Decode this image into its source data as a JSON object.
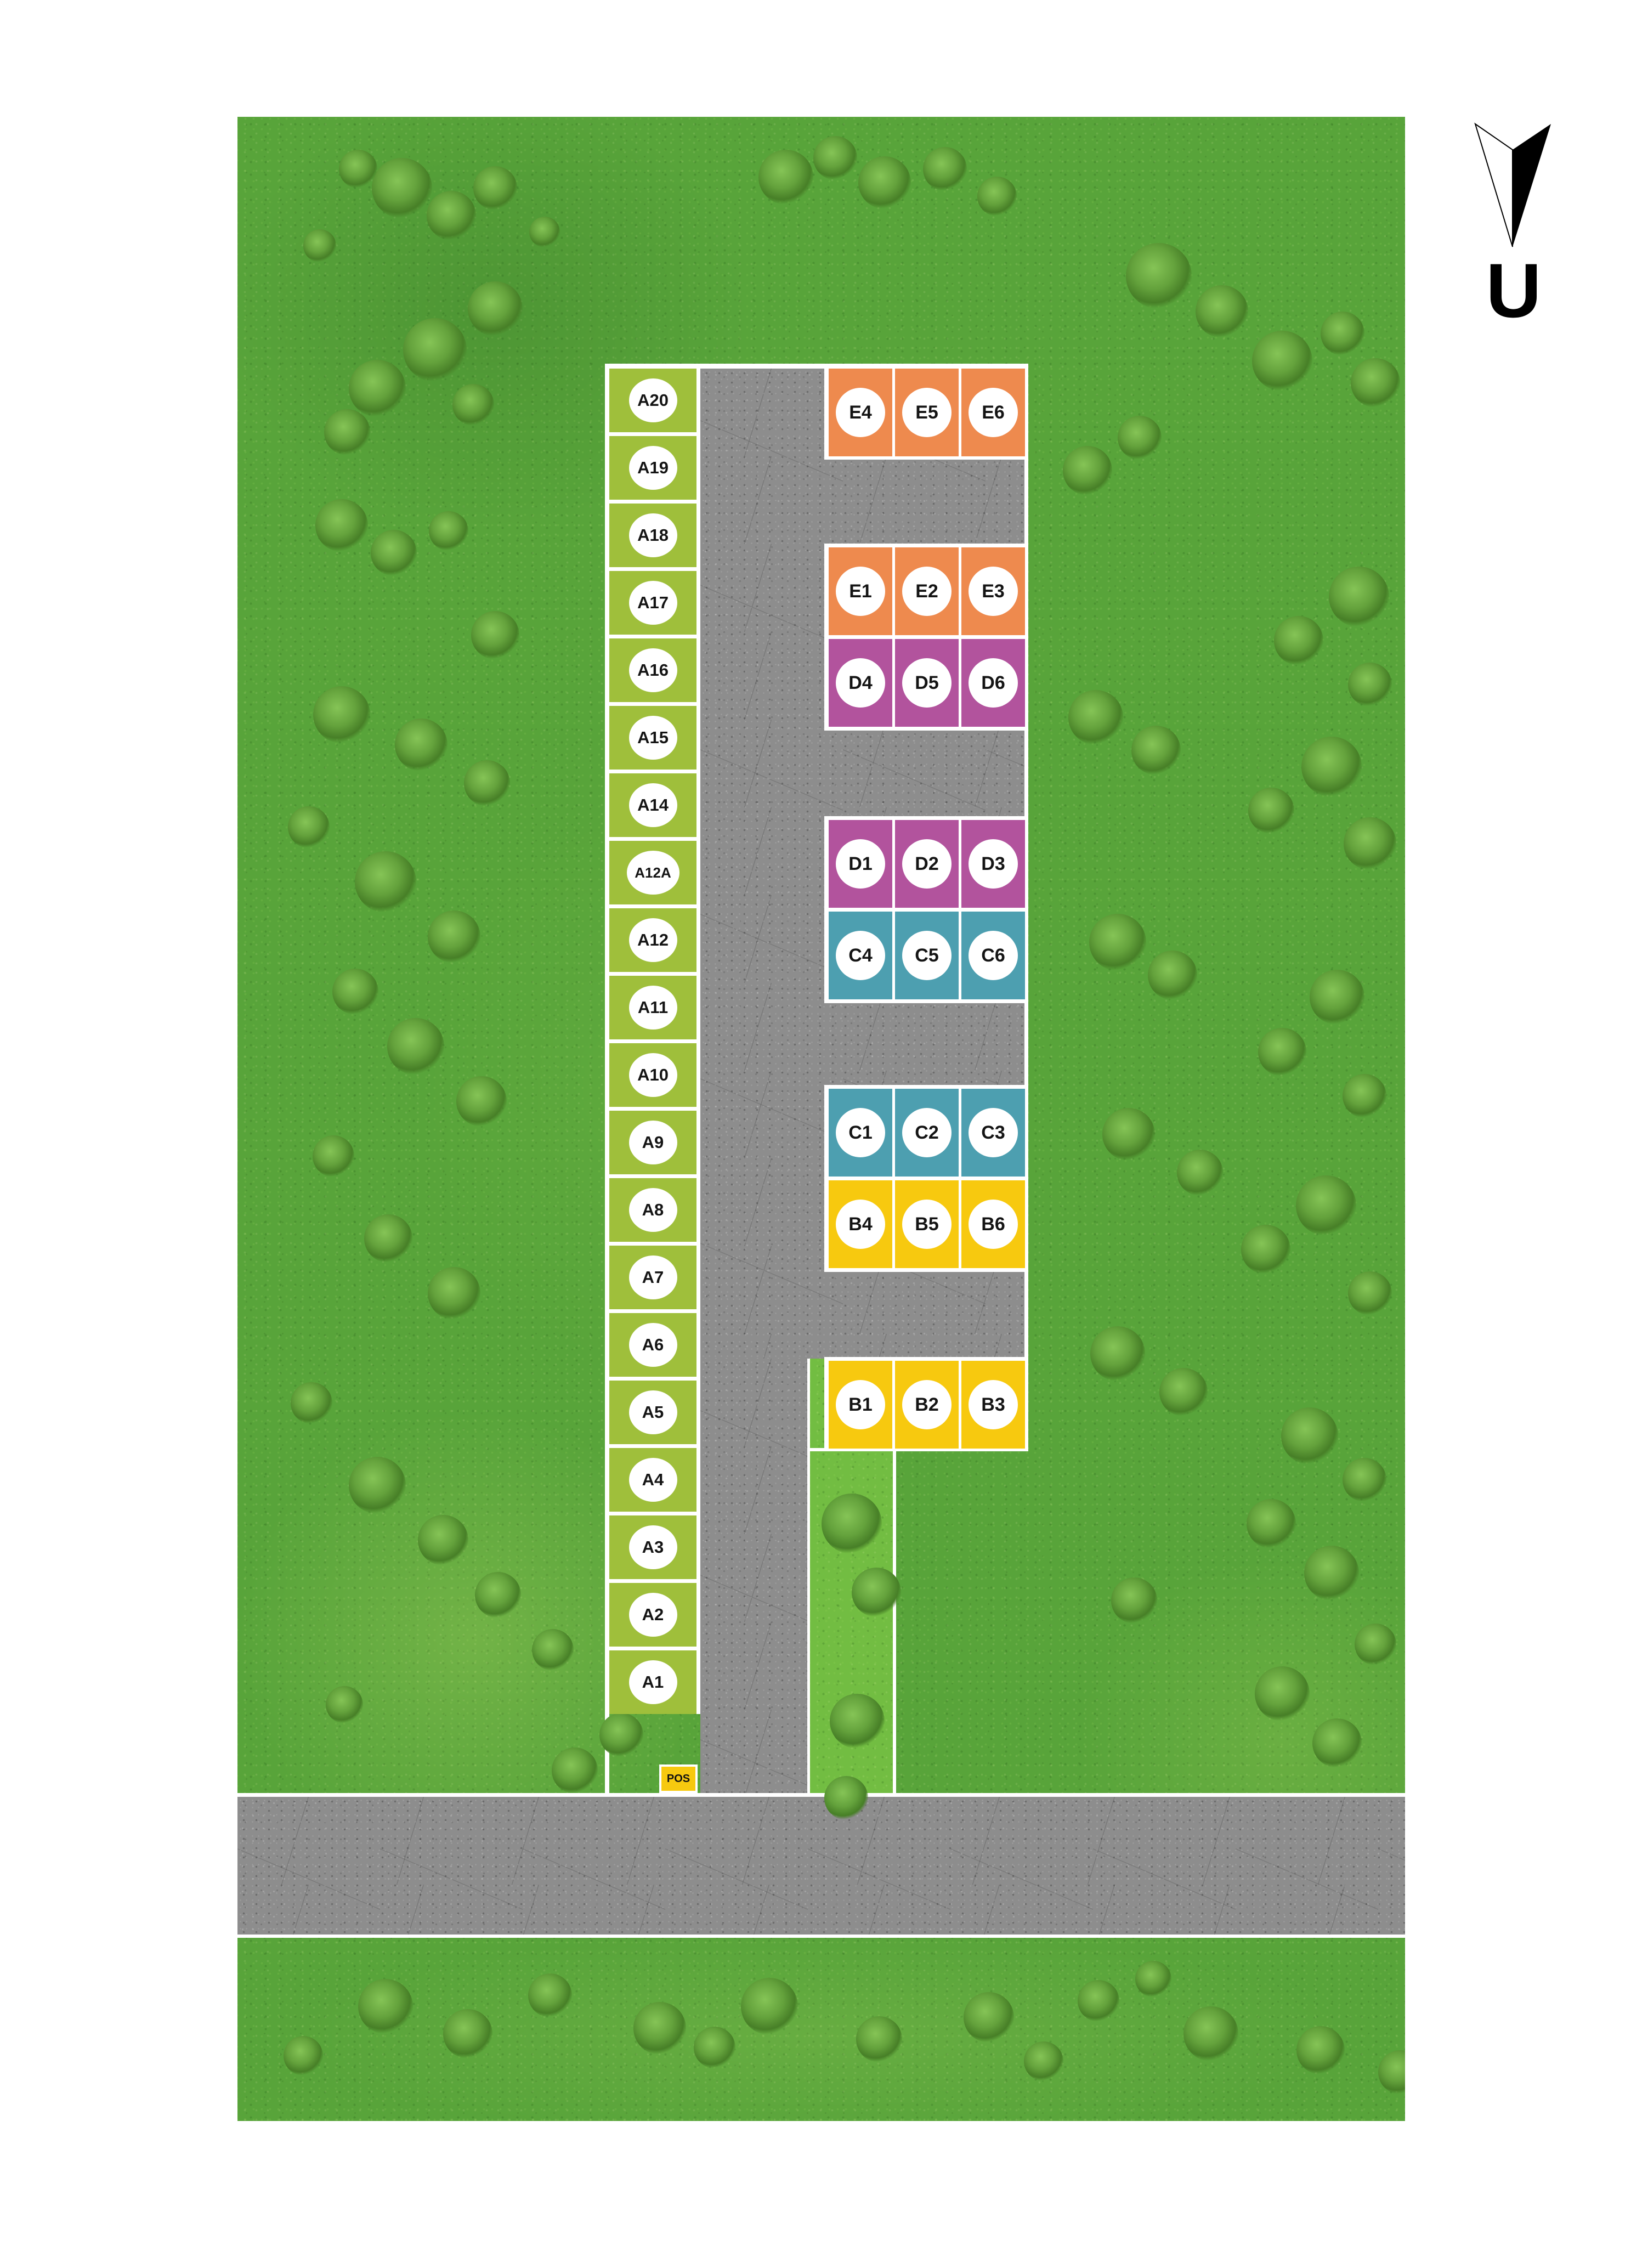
{
  "compass": {
    "letter": "U"
  },
  "site_plan": {
    "pos_label": "POS",
    "colors": {
      "a_green": "#9fbf3b",
      "e_orange": "#ee8a4e",
      "d_purple": "#b2539d",
      "c_teal": "#4d9fb0",
      "b_yellow": "#f7c90f",
      "pos_yellow": "#f7c90f",
      "road_gray": "#8d8d8d",
      "grass_green": "#58a43a",
      "grass_light_green": "#72bd42",
      "boundary_white": "#ffffff"
    },
    "a_column": {
      "labels": [
        "A20",
        "A19",
        "A18",
        "A17",
        "A16",
        "A15",
        "A14",
        "A12A",
        "A12",
        "A11",
        "A10",
        "A9",
        "A8",
        "A7",
        "A6",
        "A5",
        "A4",
        "A3",
        "A2",
        "A1"
      ]
    },
    "groups": [
      {
        "name": "block-e4-e6",
        "rows": [
          {
            "color_key": "e_orange",
            "labels": [
              "E4",
              "E5",
              "E6"
            ]
          }
        ]
      },
      {
        "name": "block-e1-d6",
        "rows": [
          {
            "color_key": "e_orange",
            "labels": [
              "E1",
              "E2",
              "E3"
            ]
          },
          {
            "color_key": "d_purple",
            "labels": [
              "D4",
              "D5",
              "D6"
            ]
          }
        ]
      },
      {
        "name": "block-d1-c6",
        "rows": [
          {
            "color_key": "d_purple",
            "labels": [
              "D1",
              "D2",
              "D3"
            ]
          },
          {
            "color_key": "c_teal",
            "labels": [
              "C4",
              "C5",
              "C6"
            ]
          }
        ]
      },
      {
        "name": "block-c1-b6",
        "rows": [
          {
            "color_key": "c_teal",
            "labels": [
              "C1",
              "C2",
              "C3"
            ]
          },
          {
            "color_key": "b_yellow",
            "labels": [
              "B4",
              "B5",
              "B6"
            ]
          }
        ]
      },
      {
        "name": "block-b1-b3",
        "rows": [
          {
            "color_key": "b_yellow",
            "labels": [
              "B1",
              "B2",
              "B3"
            ]
          }
        ]
      }
    ]
  }
}
